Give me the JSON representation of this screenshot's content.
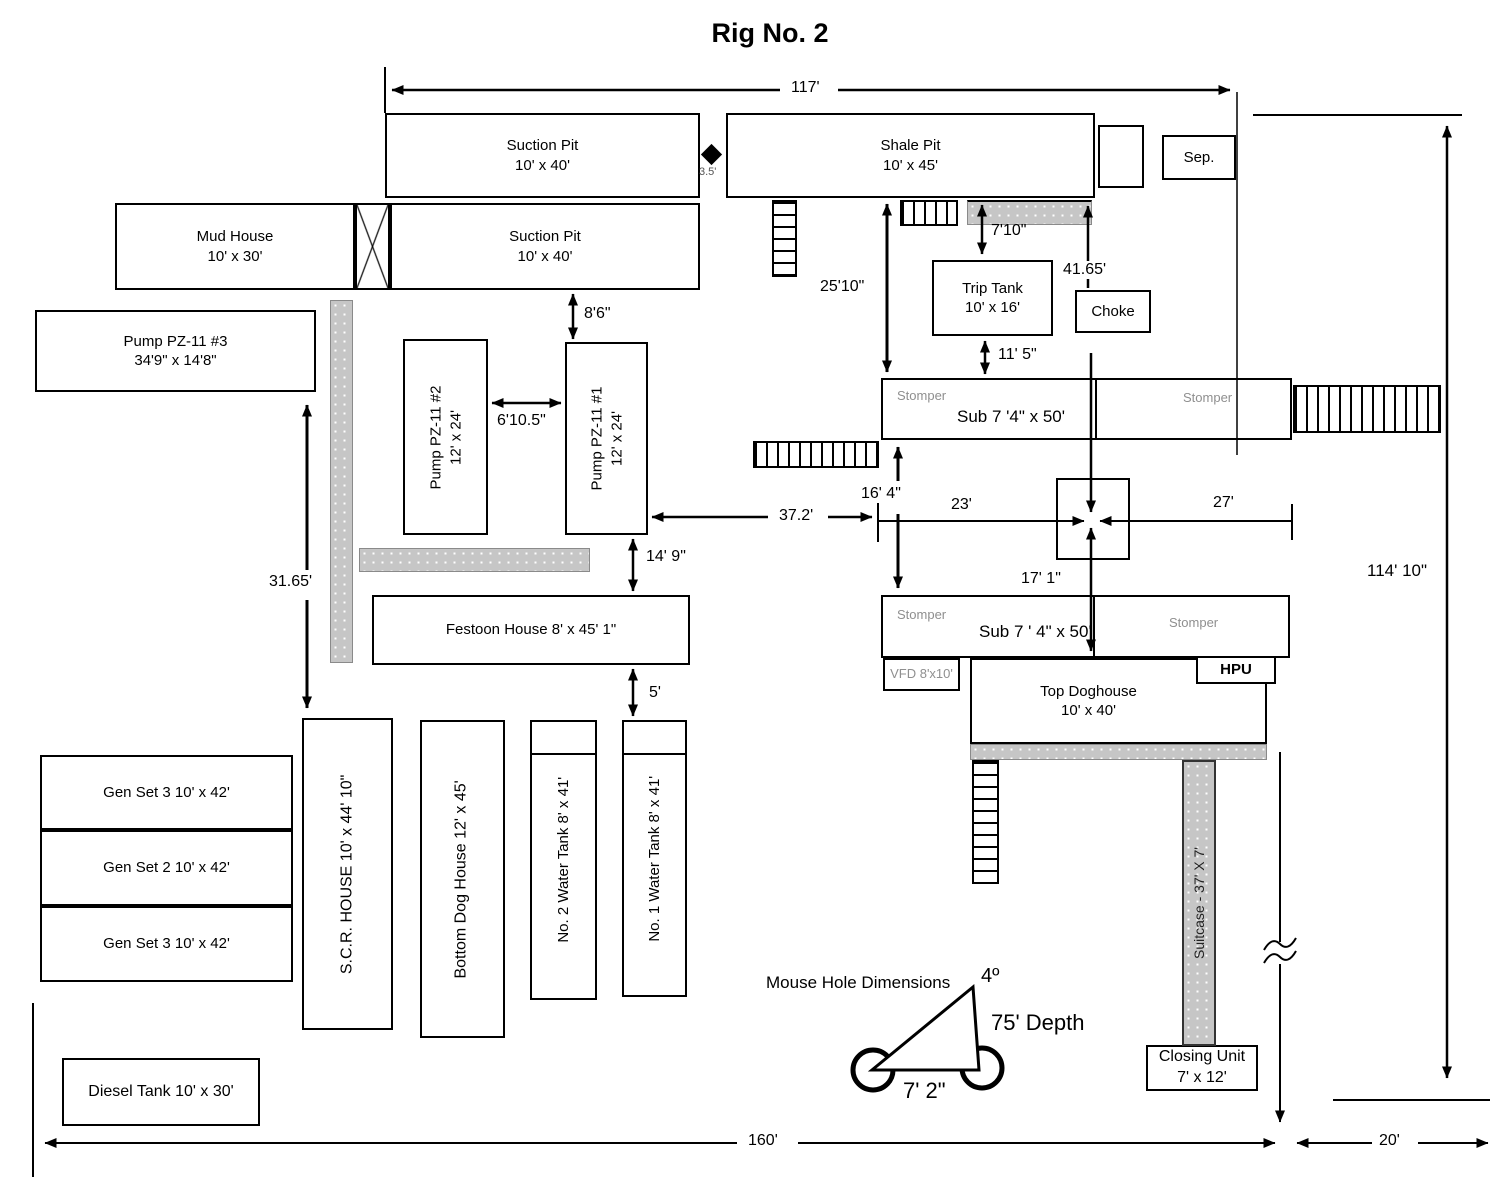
{
  "title": "Rig No. 2",
  "boxes": {
    "suction_pit_1": {
      "name": "Suction Pit",
      "size": "10' x 40'"
    },
    "shale_pit": {
      "name": "Shale Pit",
      "size": "10' x 45'"
    },
    "sep": {
      "name": "Sep."
    },
    "mud_house": {
      "name": "Mud House",
      "size": "10' x 30'"
    },
    "suction_pit_2": {
      "name": "Suction Pit",
      "size": "10' x 40'"
    },
    "pump_3": {
      "name": "Pump PZ-11 #3",
      "size": "34'9\" x 14'8\""
    },
    "pump_2": {
      "name": "Pump PZ-11 #2",
      "size": "12' x 24'"
    },
    "pump_1": {
      "name": "Pump PZ-11 #1",
      "size": "12' x 24'"
    },
    "trip_tank": {
      "name": "Trip Tank",
      "size": "10' x 16'"
    },
    "choke": {
      "name": "Choke"
    },
    "sub_upper": {
      "name": "Sub 7 '4\" x 50'",
      "stomper_left": "Stomper",
      "stomper_right": "Stomper"
    },
    "sub_lower": {
      "name": "Sub 7 ' 4\" x 50'",
      "stomper_left": "Stomper",
      "stomper_right": "Stomper"
    },
    "vfd": {
      "name": "VFD 8'x10'"
    },
    "top_doghouse": {
      "name": "Top Doghouse",
      "size": "10' x 40'"
    },
    "hpu": {
      "name": "HPU"
    },
    "festoon_house": {
      "name": "Festoon House 8' x 45' 1\""
    },
    "gen_set_a": {
      "name": "Gen Set 3 10' x 42'"
    },
    "gen_set_b": {
      "name": "Gen Set 2 10' x 42'"
    },
    "gen_set_c": {
      "name": "Gen Set 3 10' x 42'"
    },
    "scr_house": {
      "name": "S.C.R. HOUSE 10' x 44' 10\""
    },
    "bottom_doghouse": {
      "name": "Bottom Dog House 12' x 45'"
    },
    "water_tank_2": {
      "name": "No. 2 Water Tank 8' x 41'"
    },
    "water_tank_1": {
      "name": "No. 1 Water Tank 8' x 41'"
    },
    "suitcase": {
      "name": "Suitcase - 37' X 7'"
    },
    "closing_unit": {
      "name": "Closing Unit",
      "size": "7' x 12'"
    },
    "diesel_tank": {
      "name": "Diesel Tank 10' x 30'"
    }
  },
  "dimensions": {
    "overall_width": "117'",
    "pit_gap": "3.5'",
    "suction_to_pump1": "8'6\"",
    "pump_gap": "6'10.5\"",
    "shale_to_sub": "25'10\"",
    "shale_to_triptank": "7'10\"",
    "choke_line": "41.65'",
    "triptank_to_sub": "11' 5\"",
    "sub_to_sub": "16' 4\"",
    "pump1_to_well": "37.2'",
    "well_left": "23'",
    "well_right": "27'",
    "well_to_sub_lower": "17' 1\"",
    "pump1_to_festoon": "14' 9\"",
    "festoon_to_tank": "5'",
    "pump3_to_genset": "31.65'",
    "overall_height": "114' 10\"",
    "base_width": "160'",
    "base_extension": "20'"
  },
  "mouse_hole": {
    "title": "Mouse Hole Dimensions",
    "angle": "4º",
    "depth": "75' Depth",
    "width": "7' 2\""
  },
  "colors": {
    "line": "#000000",
    "walkway_gray": "#c6c6c6",
    "muted_label": "#8f8f8f"
  }
}
